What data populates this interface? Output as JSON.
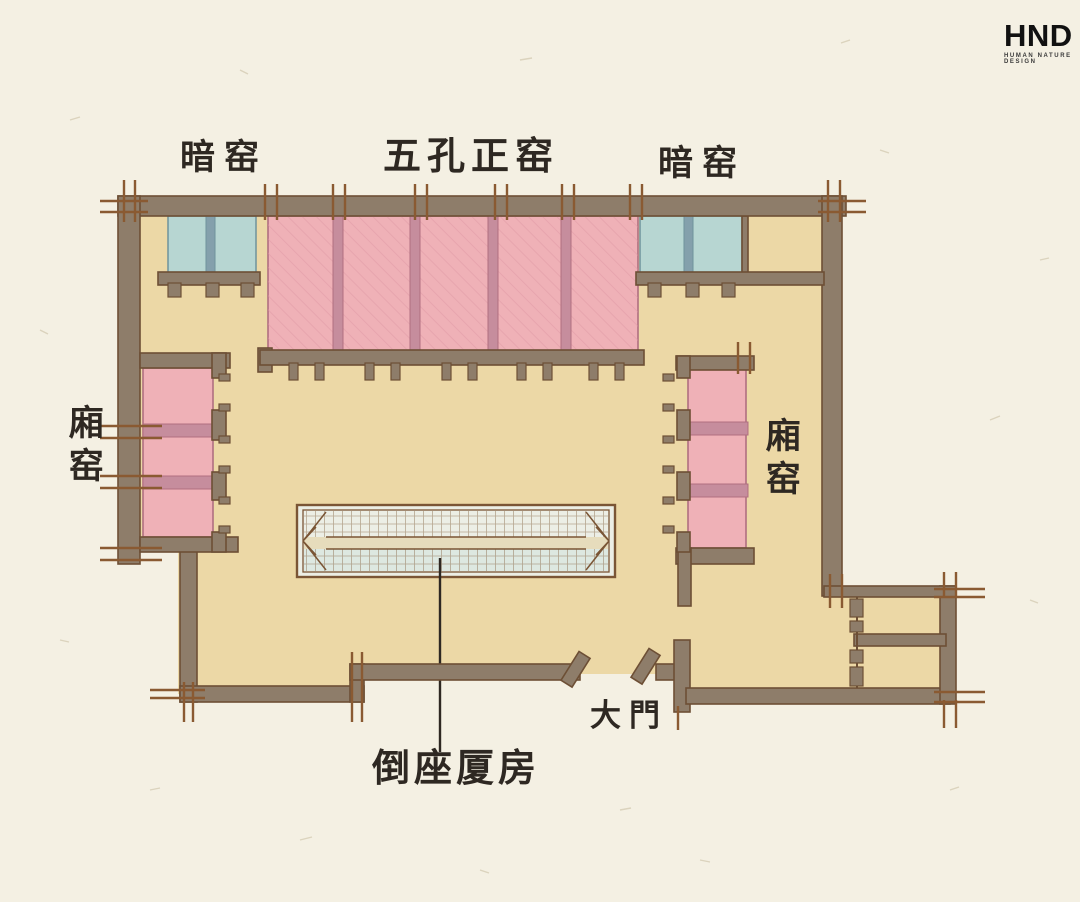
{
  "logo": {
    "name": "HND",
    "tagline": "HUMAN NATURE DESIGN"
  },
  "labels": {
    "dark_kiln_left": "暗窑",
    "main_kiln": "五孔正窑",
    "dark_kiln_right": "暗窑",
    "side_kiln_left": "廂窑",
    "side_kiln_right": "廂窑",
    "gate": "大門",
    "reversed_annex": "倒座厦房"
  },
  "colors": {
    "paper": "#f4f0e3",
    "floor": "#ecd8a6",
    "wall": "#8e7d6a",
    "wall_edge": "#6d4f35",
    "tick": "#8a5a32",
    "pink": "#efb1b7",
    "pink_hatch": "#de97a3",
    "pink_edge": "#b06f80",
    "pink_divider": "#c68d9d",
    "teal": "#b7d6d2",
    "teal_edge": "#6f939c",
    "teal_divider": "#84a0ac",
    "roof_top": "#eceee5",
    "roof_bottom": "#dde8e1",
    "roof_band": "#e6dcbc",
    "roof_grid": "#8a6a49",
    "roof_line": "#7a5535",
    "ink": "#2e2822"
  }
}
